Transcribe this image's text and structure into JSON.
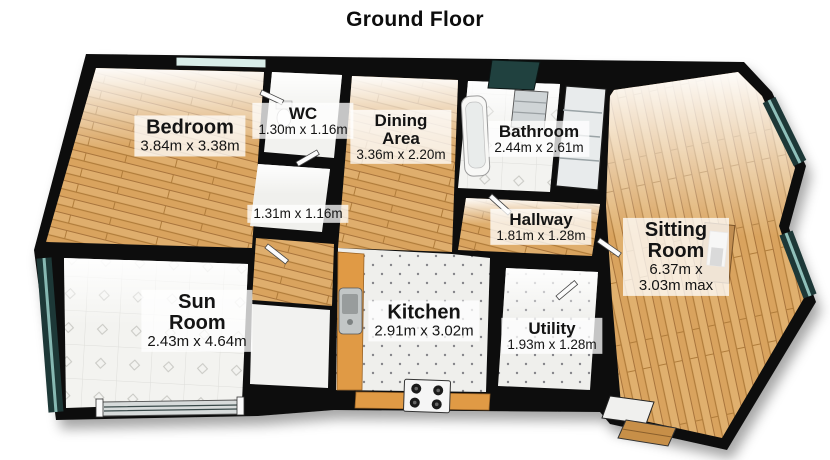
{
  "title": "Ground Floor",
  "plan": {
    "rooms": [
      {
        "id": "bedroom",
        "name": "Bedroom",
        "dims": "3.84m x 3.38m"
      },
      {
        "id": "wc",
        "name": "WC",
        "dims": "1.30m x 1.16m"
      },
      {
        "id": "dining",
        "name": "Dining Area",
        "dims": "3.36m x 2.20m"
      },
      {
        "id": "bathroom",
        "name": "Bathroom",
        "dims": "2.44m x 2.61m"
      },
      {
        "id": "store",
        "name": "",
        "dims": "1.31m x 1.16m"
      },
      {
        "id": "hallway",
        "name": "Hallway",
        "dims": "1.81m x 1.28m"
      },
      {
        "id": "sitting",
        "name": "Sitting Room",
        "dims": "6.37m x 3.03m max"
      },
      {
        "id": "sunroom",
        "name": "Sun Room",
        "dims": "2.43m x 4.64m"
      },
      {
        "id": "kitchen",
        "name": "Kitchen",
        "dims": "2.91m x 3.02m"
      },
      {
        "id": "utility",
        "name": "Utility",
        "dims": "1.93m x 1.28m"
      }
    ],
    "colors": {
      "wall": "#111111",
      "wood_floor": "#d9a35e",
      "tile_floor": "#f3f3f0",
      "window_glass_dark": "#1d3837",
      "window_glass_light": "#d8ece8",
      "kitchen_counter": "#e09a45",
      "label_background": "rgba(255,255,255,0.76)"
    }
  }
}
